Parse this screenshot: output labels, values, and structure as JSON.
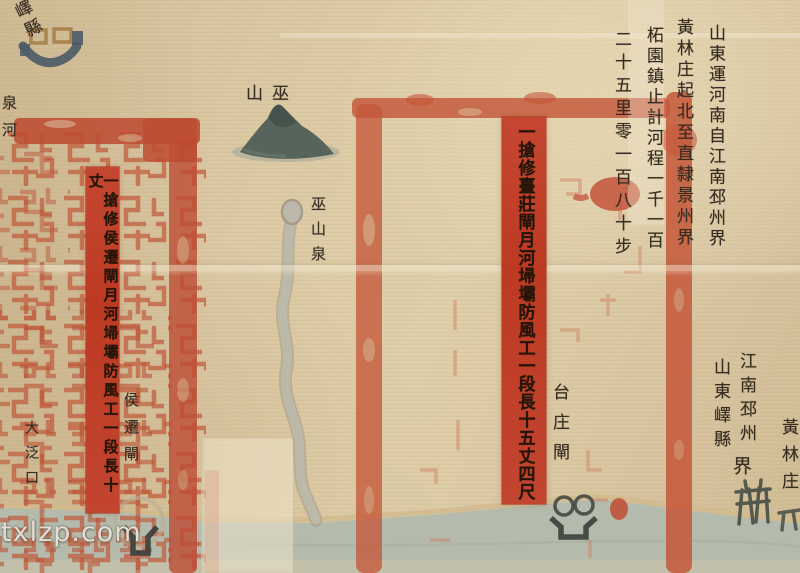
{
  "map": {
    "city": {
      "label": "嶧縣"
    },
    "quan_river_label": "泉河",
    "dafankou_label": "大泛口",
    "left_notice": {
      "text": "一搶修侯遷閘月河埽壩防風工一段長十丈"
    },
    "houqian_lock_label": "侯遷閘",
    "mountain_label": "巫山",
    "spring_label": "巫山泉",
    "right_notice": {
      "text": "一搶修臺莊閘月河埽壩防風工一段長十五丈四尺"
    },
    "taizhuang_lock_label": "台庄閘",
    "calligraphy": {
      "columns": [
        "山東運河南自江南邳州界",
        "黃林庄起北至直隸景州界",
        "柘園鎮止計河程一千一百",
        "二十五里零一百八十步"
      ]
    },
    "boundary": {
      "right_col": "江南邳州",
      "left_col": "山東嶧縣",
      "suffix": "界"
    },
    "huanglin_village_label": "黃林庄"
  },
  "watermark": "txlzp.com",
  "colors": {
    "paper": "#dbc9a4",
    "seal_red": "#c05a3c",
    "notice_red": "#bf3c24",
    "ink": "#362c21",
    "river": "#b5bcae",
    "mountain": "#55635b",
    "shoreline": "#d2ba8e"
  }
}
